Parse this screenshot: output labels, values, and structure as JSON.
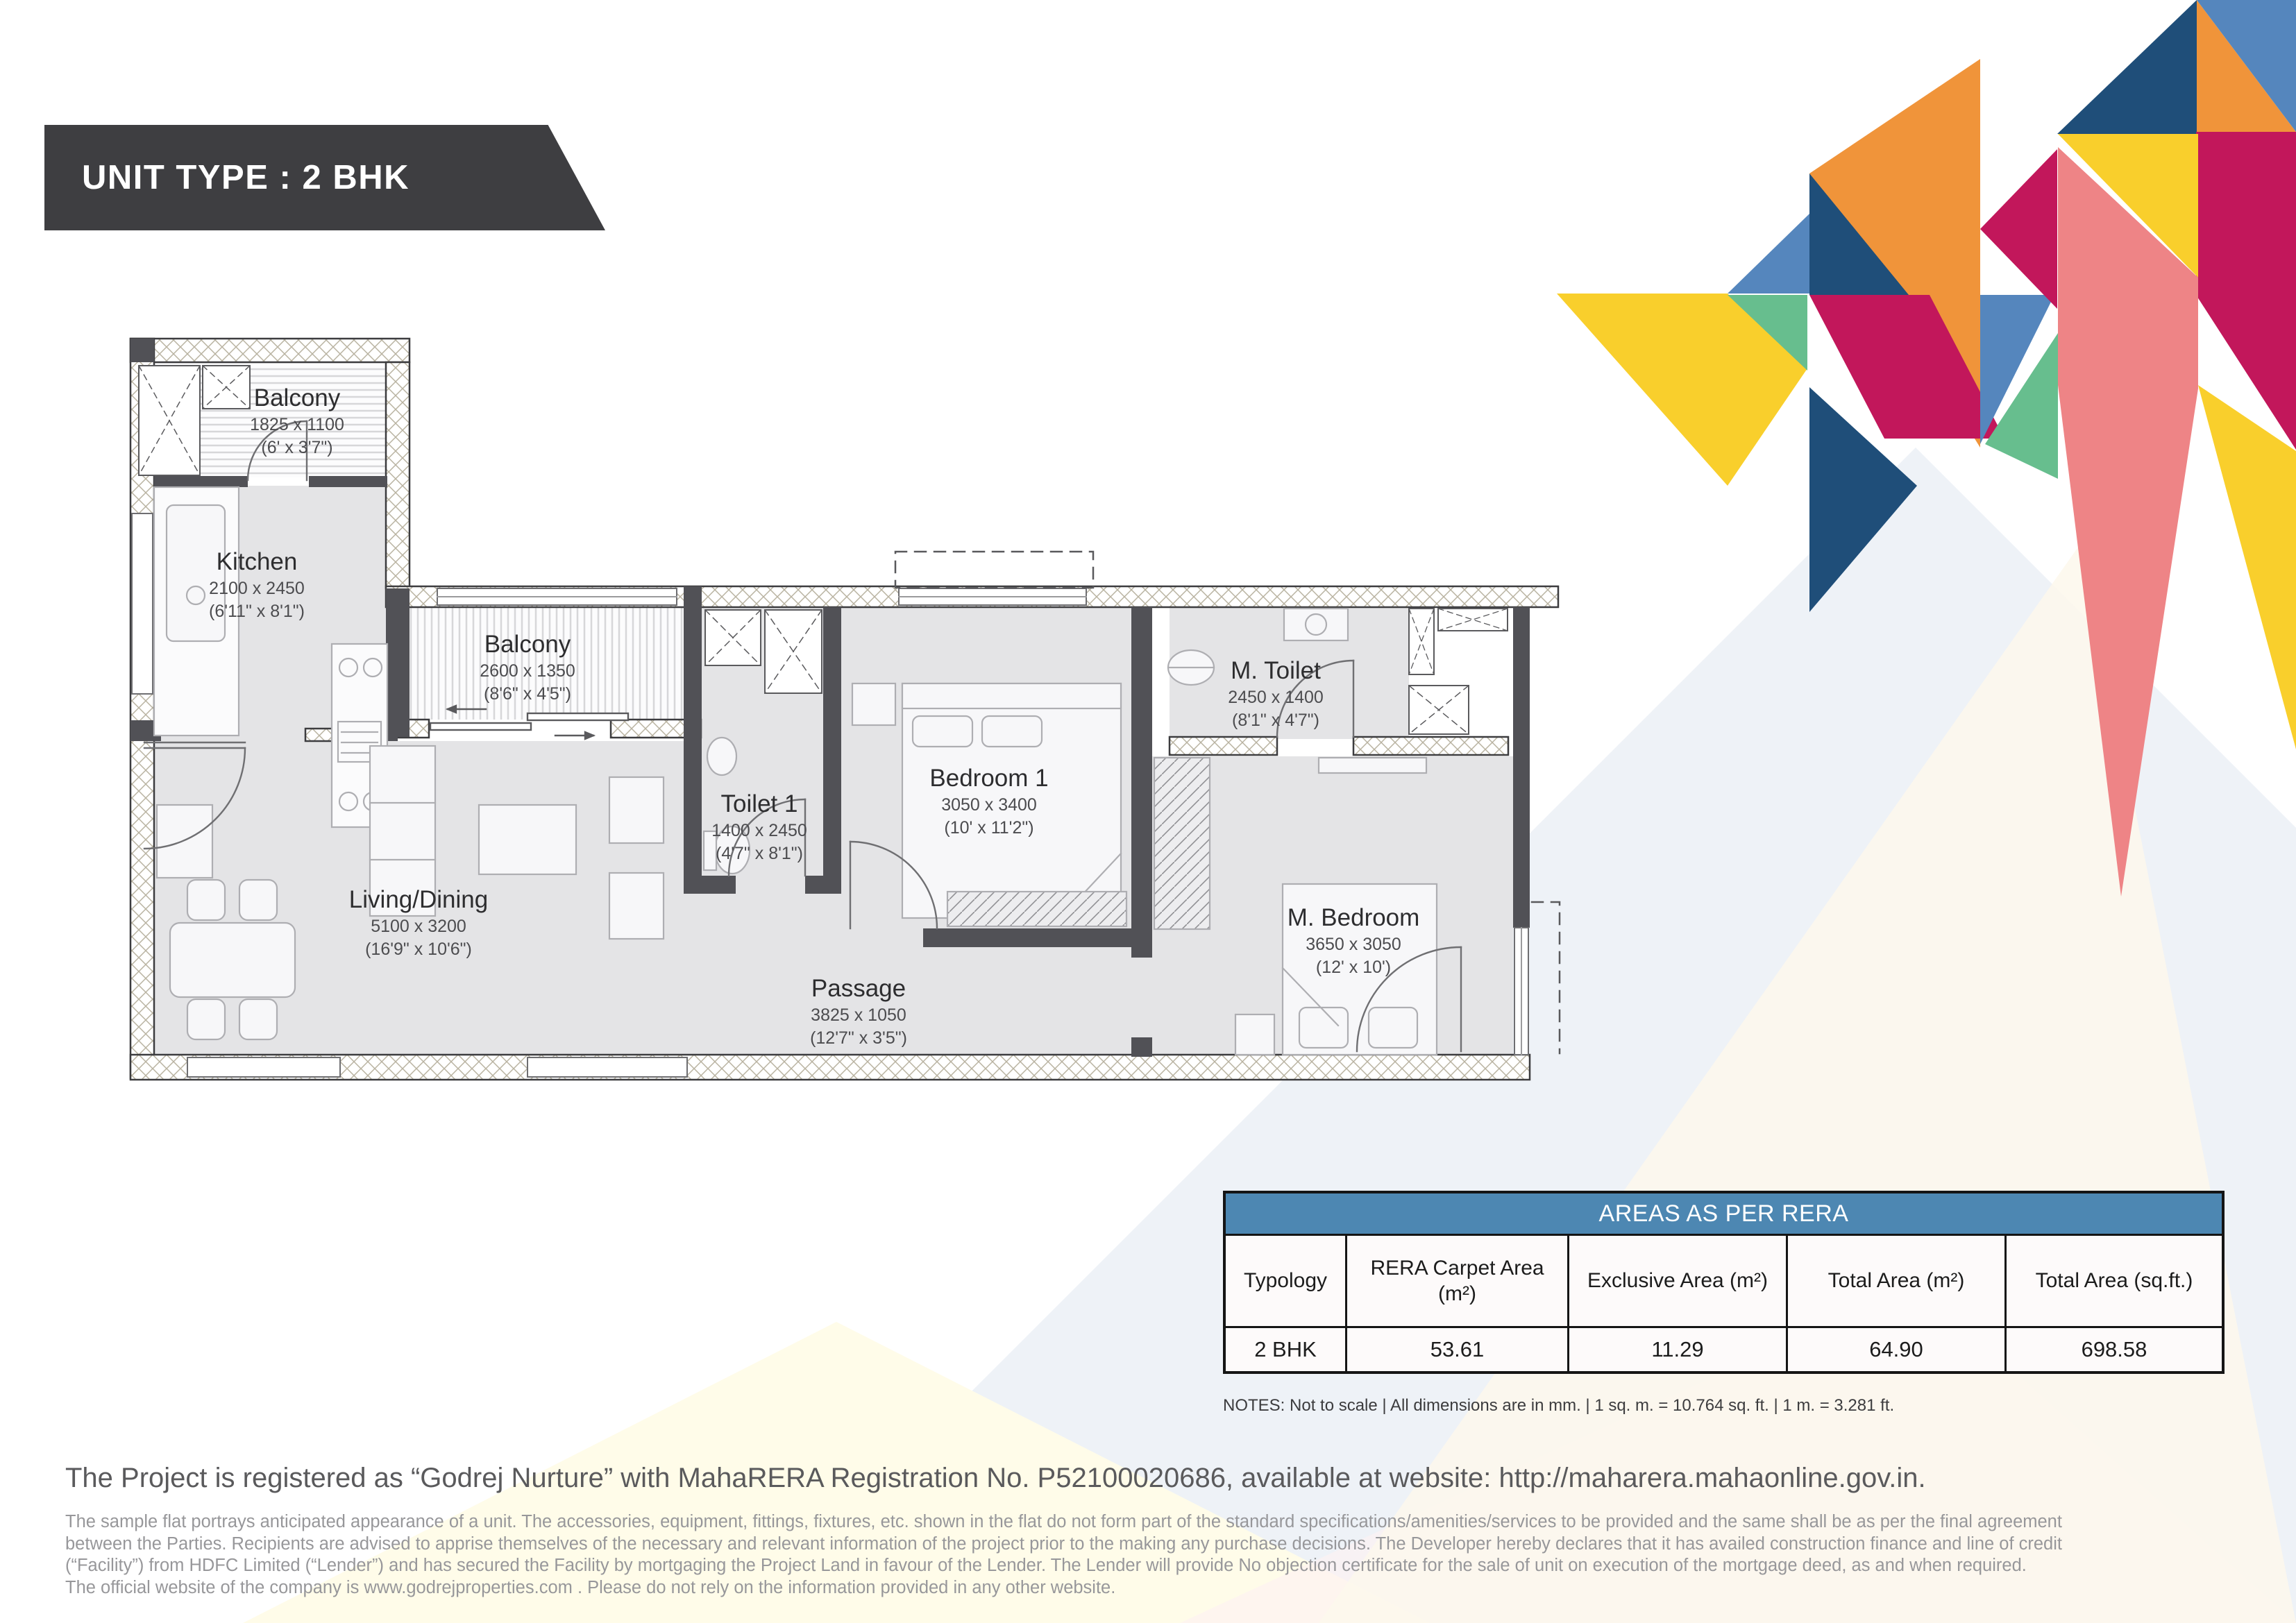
{
  "banner": {
    "title": "UNIT TYPE : 2 BHK",
    "bg": "#3e3e41"
  },
  "plan": {
    "rooms": [
      {
        "id": "balcony-top",
        "name": "Balcony",
        "dim_mm": "1825 x 1100",
        "dim_ft": "(6' x 3'7\")"
      },
      {
        "id": "kitchen",
        "name": "Kitchen",
        "dim_mm": "2100 x 2450",
        "dim_ft": "(6'11\" x 8'1\")"
      },
      {
        "id": "balcony-mid",
        "name": "Balcony",
        "dim_mm": "2600 x 1350",
        "dim_ft": "(8'6\" x 4'5\")"
      },
      {
        "id": "toilet-1",
        "name": "Toilet 1",
        "dim_mm": "1400 x 2450",
        "dim_ft": "(4'7\" x 8'1\")"
      },
      {
        "id": "bedroom-1",
        "name": "Bedroom 1",
        "dim_mm": "3050 x 3400",
        "dim_ft": "(10' x 11'2\")"
      },
      {
        "id": "m-toilet",
        "name": "M. Toilet",
        "dim_mm": "2450 x 1400",
        "dim_ft": "(8'1\" x 4'7\")"
      },
      {
        "id": "living-dining",
        "name": "Living/Dining",
        "dim_mm": "5100 x 3200",
        "dim_ft": "(16'9\" x 10'6\")"
      },
      {
        "id": "passage",
        "name": "Passage",
        "dim_mm": "3825 x 1050",
        "dim_ft": "(12'7\" x 3'5\")"
      },
      {
        "id": "m-bedroom",
        "name": "M. Bedroom",
        "dim_mm": "3650 x 3050",
        "dim_ft": "(12' x 10')"
      }
    ]
  },
  "table": {
    "title": "AREAS AS PER RERA",
    "header_bg": "#4d87b2",
    "columns": [
      "Typology",
      "RERA Carpet Area (m²)",
      "Exclusive Area (m²)",
      "Total Area (m²)",
      "Total Area (sq.ft.)"
    ],
    "row": {
      "typology": "2 BHK",
      "rera_carpet": "53.61",
      "exclusive": "11.29",
      "total_m2": "64.90",
      "total_sqft": "698.58"
    },
    "notes": "NOTES: Not to scale | All dimensions are in mm. | 1 sq. m. = 10.764 sq. ft. | 1 m. = 3.281 ft."
  },
  "footer": {
    "registration": "The Project is registered as “Godrej Nurture” with MahaRERA Registration No. P52100020686, available at website: http://maharera.mahaonline.gov.in.",
    "disclaimer_lines": [
      "The sample flat portrays anticipated appearance of a unit. The accessories, equipment, fittings, fixtures, etc. shown in the flat do not form part of the standard specifications/amenities/services to be provided and the same shall be as per the final agreement",
      "between the Parties. Recipients are advised to apprise themselves of the necessary and relevant information of the project prior to the making any purchase decisions. The Developer hereby declares that it has availed construction finance and line of credit",
      "(“Facility”) from HDFC Limited (“Lender”) and has secured the Facility by mortgaging the Project Land in favour of the Lender. The Lender will provide No objection certificate for the sale of unit on execution of the mortgage deed, as and when required.",
      "The official website of the company is www.godrejproperties.com . Please do not rely on the information provided in any other website."
    ]
  },
  "colors": {
    "orange": "#f0943a",
    "yellow": "#f9cf2c",
    "crimson": "#c2175b",
    "navy": "#1f4e79",
    "steel": "#5586bd",
    "green": "#67be8e",
    "salmon": "#ee8486",
    "wm_gray": "#eef2f7",
    "wm_cream": "#fdf8ec",
    "wm_yellow": "#fffce9",
    "wm_pink": "#fdf1f3",
    "wall_dark": "#515156",
    "floor": "#e4e4e6"
  }
}
